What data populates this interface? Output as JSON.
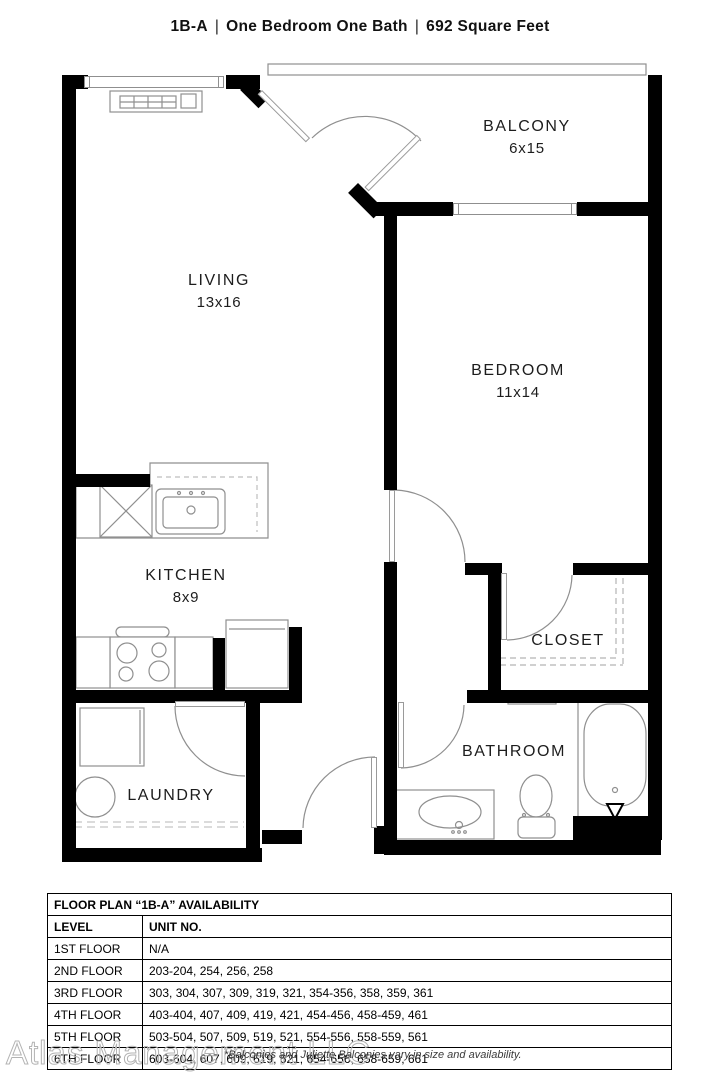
{
  "header": {
    "unit_code": "1B-A",
    "divider": "|",
    "description": "One Bedroom One Bath",
    "area": "692 Square Feet"
  },
  "rooms": {
    "living": {
      "name": "LIVING",
      "dims": "13x16"
    },
    "balcony": {
      "name": "BALCONY",
      "dims": "6x15"
    },
    "bedroom": {
      "name": "BEDROOM",
      "dims": "11x14"
    },
    "kitchen": {
      "name": "KITCHEN",
      "dims": "8x9"
    },
    "closet": {
      "name": "CLOSET"
    },
    "bathroom": {
      "name": "BATHROOM"
    },
    "laundry": {
      "name": "LAUNDRY"
    }
  },
  "availability": {
    "title": "FLOOR PLAN “1B-A” AVAILABILITY",
    "columns": {
      "level": "LEVEL",
      "unit": "UNIT NO."
    },
    "rows": [
      {
        "level": "1ST FLOOR",
        "units": "N/A"
      },
      {
        "level": "2ND FLOOR",
        "units": "203-204, 254, 256, 258"
      },
      {
        "level": "3RD FLOOR",
        "units": "303, 304, 307, 309, 319, 321, 354-356, 358, 359, 361"
      },
      {
        "level": "4TH FLOOR",
        "units": "403-404, 407, 409, 419, 421, 454-456, 458-459, 461"
      },
      {
        "level": "5TH FLOOR",
        "units": "503-504, 507, 509, 519, 521, 554-556, 558-559, 561"
      },
      {
        "level": "6TH FLOOR",
        "units": "603-604, 607, 609, 619, 621, 654-656, 658-659, 661"
      }
    ]
  },
  "footnote": "*Balconies and Juliette Balconies vary in size and availability.",
  "watermark": "Atlas Management LLC",
  "colors": {
    "wall": "#000000",
    "fixture_line": "#8f8f8f",
    "label_text": "#1d1d1d",
    "watermark": "#b3b3b3"
  }
}
